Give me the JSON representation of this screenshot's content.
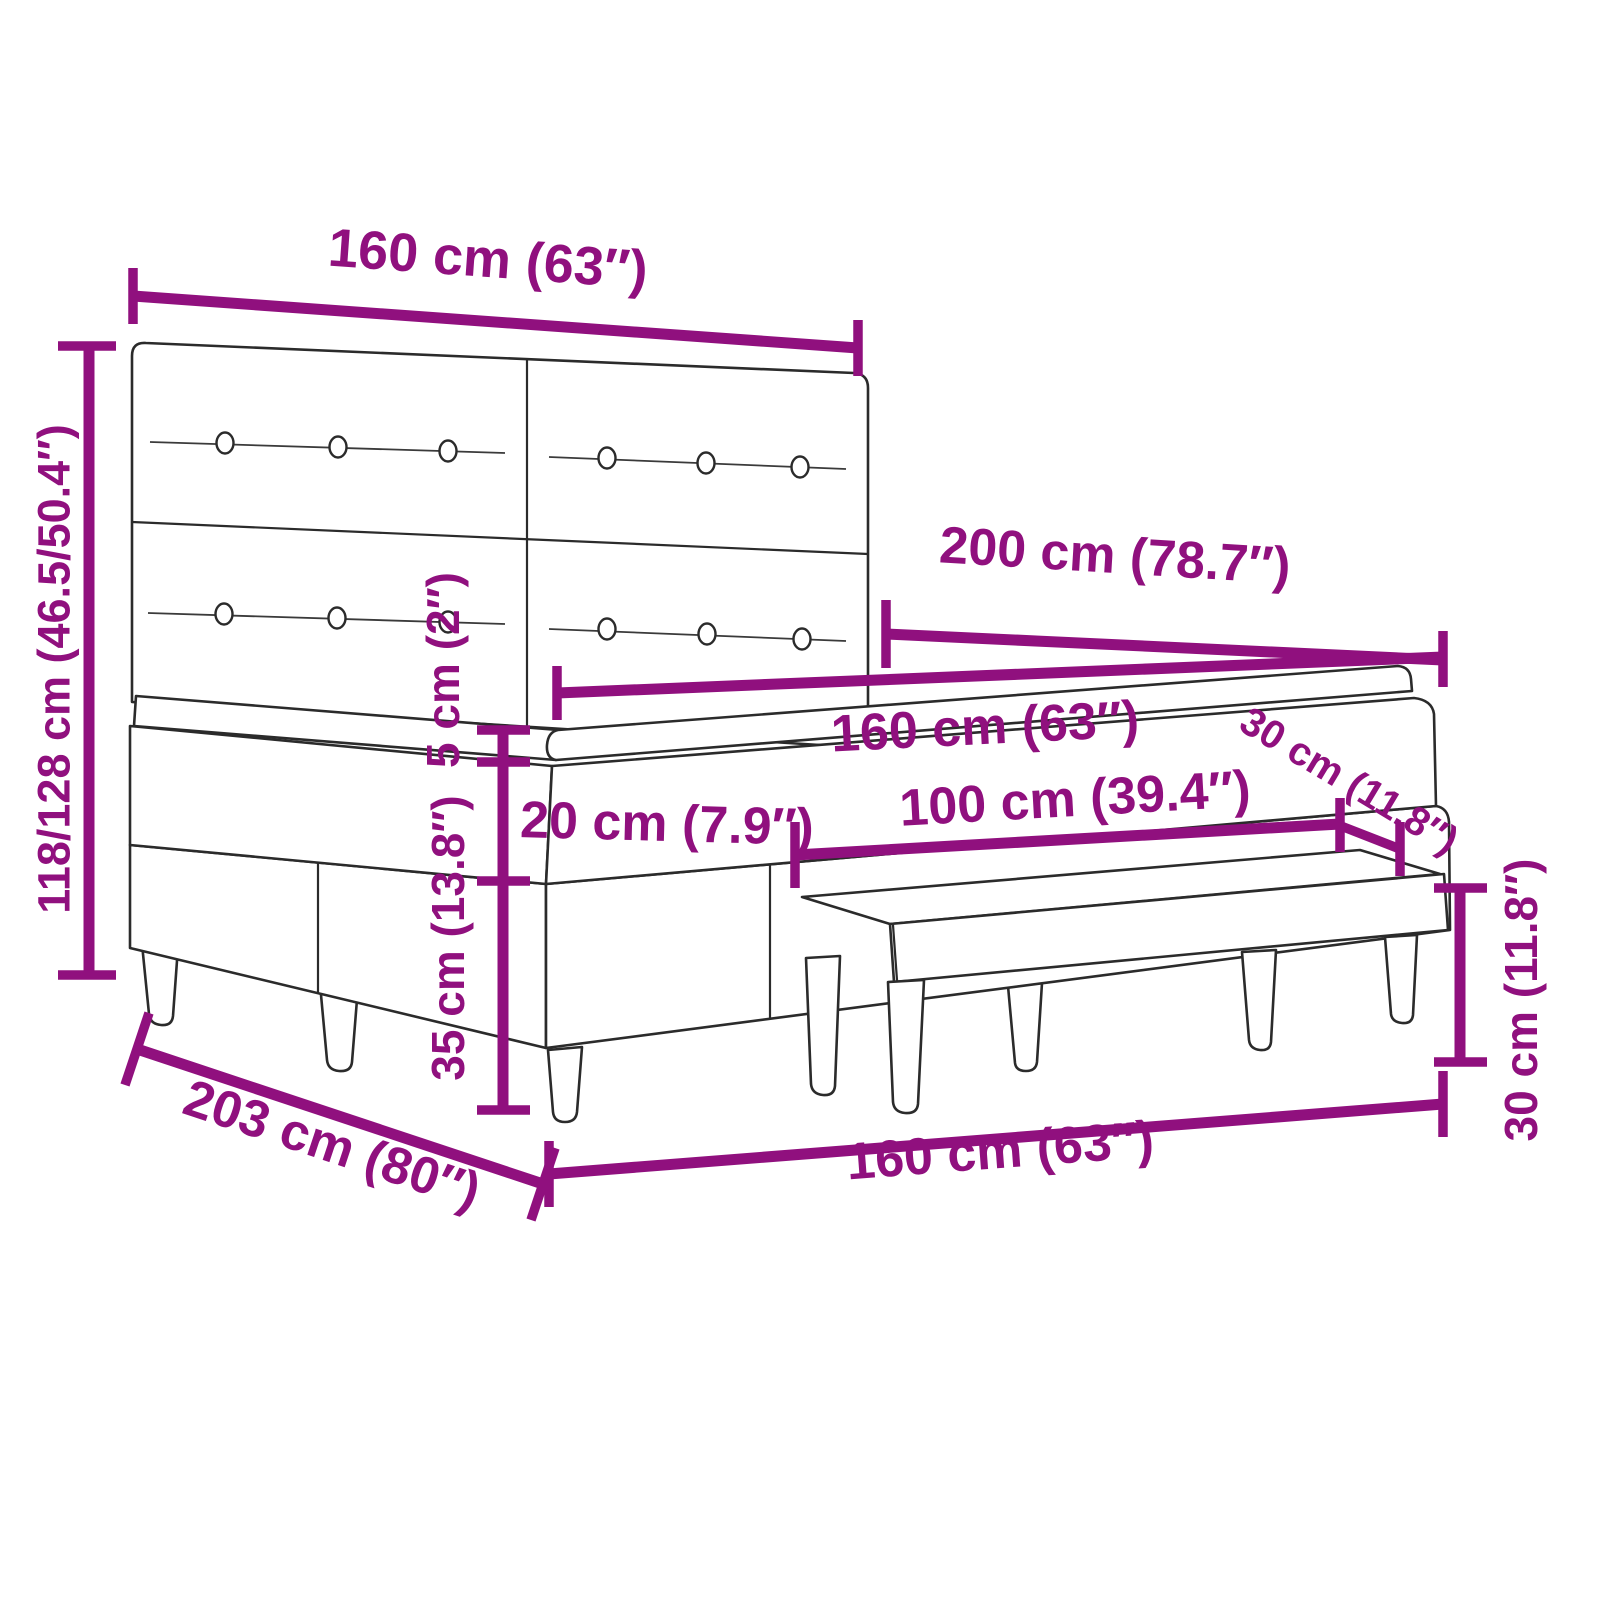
{
  "diagram": {
    "title": "Box spring bed with headboard, mattress, topper and bench — dimension diagram",
    "accent_color": "#90107E",
    "line_color": "#2B2B2B",
    "background_color": "#FFFFFF",
    "labels": {
      "headboard_width": "160 cm (63″)",
      "overall_height": "118/128 cm (46.5/50.4″)",
      "bed_length": "200 cm (78.7″)",
      "mattress_width": "160 cm (63″)",
      "topper_thickness": "5 cm (2″)",
      "mattress_thickness": "20 cm (7.9″)",
      "bench_length": "100 cm (39.4″)",
      "base_height": "35 cm (13.8″)",
      "bench_depth": "30 cm (11.8″)",
      "overall_length": "203 cm (80″)",
      "bed_width": "160 cm (63″)",
      "bench_height": "30 cm (11.8″)"
    }
  }
}
